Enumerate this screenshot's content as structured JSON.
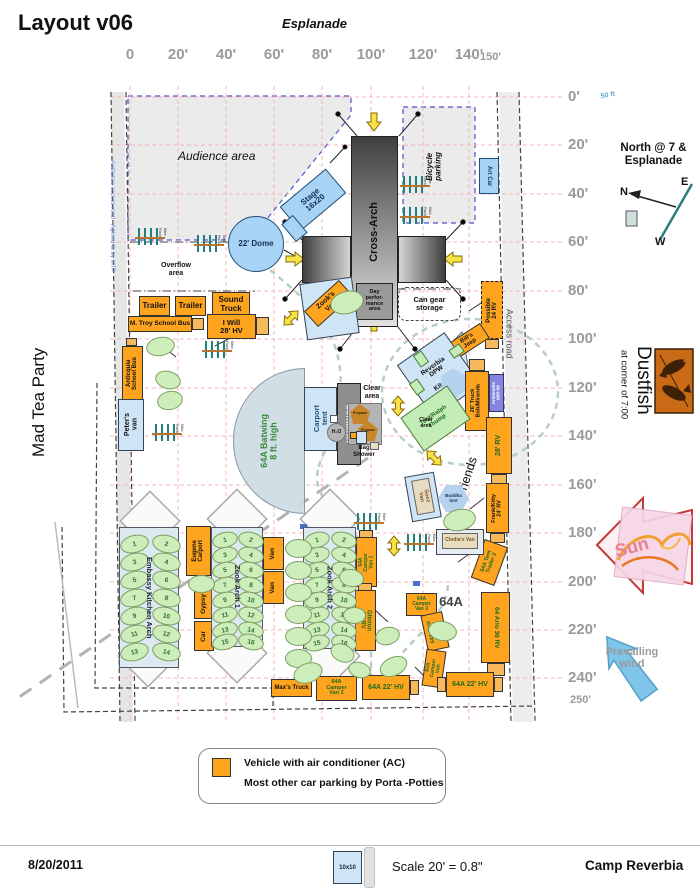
{
  "header": {
    "title": "Layout v06",
    "esplanade": "Esplanade"
  },
  "side": {
    "left": "Mad Tea Party",
    "dustfish": "Dustfish",
    "dustfish_sub": "at corner of 7:00",
    "camp_bottom": "Camp Reverbia"
  },
  "compass": {
    "title": "North @ 7 &\nEsplanade",
    "n": "N",
    "e": "E",
    "w": "W"
  },
  "rulers": {
    "top": [
      "0",
      "20'",
      "40'",
      "60'",
      "80'",
      "100'",
      "120'",
      "140'"
    ],
    "top_end": "150'",
    "right": [
      "0'",
      "20'",
      "40'",
      "60'",
      "80'",
      "100'",
      "120'",
      "140'",
      "160'",
      "180'",
      "200'",
      "220'",
      "240'"
    ],
    "right_end": "250'"
  },
  "legend": {
    "line1": "Vehicle with air conditioner (AC)",
    "line2": "Most other car parking by Porta -Potties"
  },
  "footer": {
    "date": "8/20/2011",
    "tent": "10x10",
    "scale": "Scale 20' = 0.8\"",
    "camp": "Camp Reverbia"
  },
  "colors": {
    "ac_vehicle": "#ffa41e",
    "structure_blue": "#a9d3f5",
    "parking_green": "#cdeebb",
    "grid_pink": "#f4b6b6"
  },
  "labels": [
    {
      "t": "Audience area",
      "x": 178,
      "y": 150,
      "fs": 12,
      "it": 1,
      "wt": 500,
      "nm": "audience-area-label"
    },
    {
      "t": "Overflow\narea",
      "x": 150,
      "y": 262,
      "w": 52,
      "fs": 7,
      "wt": 600,
      "nm": "overflow-area-label"
    },
    {
      "t": "Clear\narea",
      "x": 352,
      "y": 385,
      "w": 40,
      "fs": 7,
      "wt": 700,
      "nm": "clear-area-label"
    },
    {
      "t": "Clear\narea",
      "x": 410,
      "y": 417,
      "w": 32,
      "fs": 5.5,
      "wt": 700,
      "nm": "clear-area-label"
    },
    {
      "t": "Bag\nShower",
      "x": 342,
      "y": 445,
      "w": 44,
      "fs": 6,
      "wt": 700,
      "nm": "bag-shower-label"
    },
    {
      "t": "64A",
      "x": 436,
      "y": 595,
      "w": 30,
      "fs": 13,
      "wt": 600,
      "tc": "#444",
      "nm": "area-64a-label"
    },
    {
      "t": "50 ft",
      "x": 596,
      "y": 92,
      "w": 24,
      "fs": 7,
      "tc": "#5fa8d0",
      "r": -10,
      "wt": 600,
      "nm": "fifty-ft-label"
    },
    {
      "t": "Sun",
      "x": 602,
      "y": 538,
      "w": 60,
      "fs": 18,
      "tc": "#e8808f",
      "r": -15,
      "wt": 700,
      "nm": "sun-label"
    },
    {
      "t": "Prevailing\nwind",
      "x": 594,
      "y": 646,
      "w": 76,
      "fs": 11,
      "tc": "#9a9a9a",
      "wt": 600,
      "nm": "prevailing-wind-label"
    }
  ],
  "boxes": [
    {
      "t": "Audience access road - Agreed to by MTP",
      "x": 104,
      "y": 96,
      "w": 16,
      "h": 240,
      "c": "none",
      "v": "d",
      "fs": 6,
      "tc": "#7090e8",
      "wt": 400,
      "nm": "audience-access-road-label"
    },
    {
      "t": "Access road",
      "x": 500,
      "y": 286,
      "w": 18,
      "h": 95,
      "c": "none",
      "v": "d",
      "fs": 9,
      "tc": "#555",
      "wt": 400,
      "nm": "access-road-label"
    },
    {
      "t": "Bicycle\nparking",
      "x": 421,
      "y": 128,
      "w": 26,
      "h": 76,
      "c": "none",
      "v": "u",
      "fs": 8,
      "it": 1,
      "wt": 600,
      "nm": "bicycle-parking-label"
    },
    {
      "t": "Sooz & Friends",
      "x": 415,
      "y": 491,
      "w": 90,
      "h": 14,
      "c": "none",
      "r": -72,
      "fs": 12.5,
      "wt": 500,
      "nm": "sooz-friends-label"
    },
    {
      "t": "Cross-Arch",
      "x": 351,
      "y": 136,
      "w": 47,
      "h": 191,
      "c": "crossv",
      "v": "u",
      "fs": 11,
      "nm": "cross-arch"
    },
    {
      "t": "",
      "x": 302,
      "y": 236,
      "w": 49,
      "h": 47,
      "c": "crossh1",
      "nm": "cross-arch-left"
    },
    {
      "t": "",
      "x": 398,
      "y": 236,
      "w": 48,
      "h": 47,
      "c": "crossh2",
      "nm": "cross-arch-right"
    },
    {
      "t": "Day\nperfor-\nmance\narea",
      "x": 356,
      "y": 283,
      "w": 37,
      "h": 37,
      "c": "dkgray",
      "fs": 5.5,
      "nm": "day-performance-area"
    },
    {
      "t": "22' Dome",
      "x": 228,
      "y": 216,
      "w": 56,
      "h": 56,
      "c": "blue circle",
      "fs": 8,
      "tc": "#0d3355",
      "nm": "dome"
    },
    {
      "t": "Stage\n16x20",
      "x": 283,
      "y": 184,
      "w": 60,
      "h": 32,
      "c": "blue",
      "r": -40,
      "fs": 8,
      "tc": "#0d3355",
      "nm": "stage"
    },
    {
      "t": "",
      "x": 287,
      "y": 217,
      "w": 15,
      "h": 23,
      "c": "blue",
      "r": -40,
      "nm": "stage-stairs"
    },
    {
      "t": "Art Car",
      "x": 479,
      "y": 158,
      "w": 20,
      "h": 36,
      "c": "blue",
      "v": "d",
      "fs": 6,
      "tc": "#123a66",
      "nm": "art-car"
    },
    {
      "t": "Trailer",
      "x": 139,
      "y": 296,
      "w": 31,
      "h": 20,
      "c": "ac",
      "fs": 8,
      "nm": "trailer"
    },
    {
      "t": "Trailer",
      "x": 175,
      "y": 296,
      "w": 31,
      "h": 20,
      "c": "ac",
      "fs": 8,
      "nm": "trailer"
    },
    {
      "t": "Sound\nTruck",
      "x": 212,
      "y": 292,
      "w": 38,
      "h": 25,
      "c": "ac",
      "fs": 8,
      "nm": "sound-truck"
    },
    {
      "t": "M. Troy School Bus",
      "x": 128,
      "y": 316,
      "w": 64,
      "h": 16,
      "c": "ac",
      "fs": 6.5,
      "nm": "school-bus"
    },
    {
      "t": "",
      "x": 192,
      "y": 318,
      "w": 12,
      "h": 12,
      "c": "acl"
    },
    {
      "t": "I Will\n28' HV",
      "x": 207,
      "y": 314,
      "w": 49,
      "h": 25,
      "c": "ac",
      "fs": 7.5,
      "nm": "i-will-hv"
    },
    {
      "t": "",
      "x": 256,
      "y": 317,
      "w": 13,
      "h": 18,
      "c": "acl"
    },
    {
      "t": "",
      "x": 126,
      "y": 338,
      "w": 11,
      "h": 8,
      "c": "acl"
    },
    {
      "t": "Anticquia\nSchool Bus",
      "x": 122,
      "y": 346,
      "w": 21,
      "h": 55,
      "c": "ac",
      "v": "u",
      "fs": 6,
      "nm": "anticquia-school-bus"
    },
    {
      "t": "Peter's\nvan",
      "x": 118,
      "y": 399,
      "w": 26,
      "h": 52,
      "c": "ltblue",
      "v": "u",
      "fs": 7,
      "nm": "peters-van"
    },
    {
      "t": "",
      "x": 303,
      "y": 280,
      "w": 53,
      "h": 57,
      "c": "ltblue",
      "r": -8,
      "nm": "zook-van-pad"
    },
    {
      "t": "Zook's\nVan",
      "x": 305,
      "y": 293,
      "w": 47,
      "h": 21,
      "c": "ac",
      "r": -42,
      "fs": 7,
      "nm": "zooks-van"
    },
    {
      "t": "Can gear\nstorage",
      "x": 398,
      "y": 287,
      "w": 63,
      "h": 34,
      "c": "dash",
      "fs": 7.5,
      "nm": "can-gear-storage"
    },
    {
      "t": "Possible\n24 RV",
      "x": 481,
      "y": 281,
      "w": 22,
      "h": 58,
      "c": "ac bd",
      "v": "u",
      "fs": 6,
      "nm": "possible-rv"
    },
    {
      "t": "",
      "x": 485,
      "y": 339,
      "w": 14,
      "h": 10,
      "c": "acl"
    },
    {
      "t": "Bill's\nJeep",
      "x": 449,
      "y": 332,
      "w": 39,
      "h": 18,
      "c": "ac",
      "r": -33,
      "fs": 6,
      "nm": "bills-jeep"
    },
    {
      "t": "",
      "x": 419,
      "y": 347,
      "w": 19,
      "h": 12,
      "c": "green",
      "r": -33
    },
    {
      "t": "Reverbia\nDPW\n\nKitchen",
      "x": 410,
      "y": 343,
      "w": 58,
      "h": 64,
      "c": "ltblue",
      "r": -35,
      "fs": 6.5,
      "nm": "reverbia-dpw-kitchen"
    },
    {
      "t": "",
      "x": 440,
      "y": 370,
      "w": 28,
      "h": 26,
      "c": "hex ghex",
      "r": -35,
      "nm": "kitchen-hex"
    },
    {
      "t": "",
      "x": 416,
      "y": 352,
      "w": 10,
      "h": 14,
      "c": "green",
      "r": -35
    },
    {
      "t": "",
      "x": 412,
      "y": 380,
      "w": 10,
      "h": 14,
      "c": "green",
      "r": -35
    },
    {
      "t": "",
      "x": 450,
      "y": 346,
      "w": 13,
      "h": 10,
      "c": "green",
      "r": -35
    },
    {
      "t": "26' Truck\nBob/Miranda",
      "x": 465,
      "y": 371,
      "w": 24,
      "h": 60,
      "c": "ac",
      "v": "u",
      "fs": 5.5,
      "nm": "truck-26"
    },
    {
      "t": "",
      "x": 469,
      "y": 359,
      "w": 16,
      "h": 12,
      "c": "acl"
    },
    {
      "t": "Antoinette\nW/H 09",
      "x": 489,
      "y": 374,
      "w": 15,
      "h": 38,
      "c": "purple",
      "v": "u",
      "fs": 4.5,
      "tc": "#fff",
      "nm": "antoinette"
    },
    {
      "t": "28' RV",
      "x": 486,
      "y": 417,
      "w": 26,
      "h": 57,
      "c": "ac",
      "v": "u",
      "fs": 7,
      "tc": "#1d6b1d",
      "nm": "rv-28"
    },
    {
      "t": "",
      "x": 491,
      "y": 474,
      "w": 16,
      "h": 10,
      "c": "acl"
    },
    {
      "t": "Frank/Kitty\n24' RV",
      "x": 486,
      "y": 483,
      "w": 23,
      "h": 50,
      "c": "ac",
      "v": "u",
      "fs": 5.5,
      "nm": "frank-kitty-rv"
    },
    {
      "t": "",
      "x": 490,
      "y": 533,
      "w": 15,
      "h": 10,
      "c": "acl"
    },
    {
      "t": "Tent/Ralph\nThump",
      "x": 407,
      "y": 398,
      "w": 57,
      "h": 41,
      "c": "green",
      "r": -35,
      "fs": 6,
      "tc": "#1d6b1d",
      "nm": "tent-ralph"
    },
    {
      "t": "64A Batwing\n8 ft. high",
      "x": 233,
      "y": 368,
      "w": 72,
      "h": 146,
      "c": "batwing",
      "v": "u",
      "fs": 9,
      "tc": "#3a8a3a",
      "nm": "batwing"
    },
    {
      "t": "Carport\ntent",
      "x": 304,
      "y": 387,
      "w": 33,
      "h": 64,
      "c": "ltblue",
      "v": "u",
      "fs": 7.5,
      "tc": "#1c4f7c",
      "nm": "carport-tent"
    },
    {
      "t": "Container",
      "x": 337,
      "y": 383,
      "w": 24,
      "h": 82,
      "c": "gray",
      "v": "d",
      "fs": 8.5,
      "tc": "#fff",
      "nm": "container"
    },
    {
      "t": "",
      "x": 330,
      "y": 415,
      "w": 8,
      "h": 8,
      "c": "white"
    },
    {
      "t": "",
      "x": 330,
      "y": 427,
      "w": 8,
      "h": 8,
      "c": "ltblue"
    },
    {
      "t": "",
      "x": 348,
      "y": 403,
      "w": 34,
      "h": 42,
      "c": "midgray",
      "nm": "propane-pad"
    },
    {
      "t": "Propane",
      "x": 350,
      "y": 404,
      "w": 20,
      "h": 20,
      "c": "pent",
      "fs": 3.5,
      "tc": "#33220a",
      "nm": "propane"
    },
    {
      "t": "Propane",
      "x": 358,
      "y": 421,
      "w": 20,
      "h": 20,
      "c": "pent",
      "fs": 3.5,
      "tc": "#33220a",
      "nm": "propane"
    },
    {
      "t": "H₂O",
      "x": 327,
      "y": 423,
      "w": 19,
      "h": 19,
      "c": "midgray circle",
      "fs": 5,
      "nm": "h2o"
    },
    {
      "t": "",
      "x": 356,
      "y": 431,
      "w": 11,
      "h": 13,
      "c": "ltblue"
    },
    {
      "t": "",
      "x": 350,
      "y": 432,
      "w": 7,
      "h": 7,
      "c": "ac"
    },
    {
      "t": "",
      "x": 370,
      "y": 442,
      "w": 9,
      "h": 8,
      "c": "tan"
    },
    {
      "t": "Eugene\nCarport",
      "x": 186,
      "y": 526,
      "w": 25,
      "h": 50,
      "c": "ac",
      "v": "u",
      "fs": 6,
      "nm": "eugene-carport"
    },
    {
      "t": "Gypsy",
      "x": 194,
      "y": 589,
      "w": 20,
      "h": 30,
      "c": "ac",
      "v": "u",
      "fs": 6.5,
      "nm": "gypsy"
    },
    {
      "t": "Car",
      "x": 194,
      "y": 621,
      "w": 20,
      "h": 30,
      "c": "ac",
      "v": "u",
      "fs": 6.5,
      "nm": "car"
    },
    {
      "t": "Van",
      "x": 263,
      "y": 537,
      "w": 21,
      "h": 33,
      "c": "ac",
      "v": "u",
      "fs": 6.5,
      "nm": "van"
    },
    {
      "t": "Van",
      "x": 263,
      "y": 571,
      "w": 21,
      "h": 33,
      "c": "ac",
      "v": "u",
      "fs": 6.5,
      "nm": "van"
    },
    {
      "t": "Max's Truck",
      "x": 271,
      "y": 679,
      "w": 41,
      "h": 18,
      "c": "ac",
      "fs": 6,
      "nm": "maxs-truck"
    },
    {
      "t": "64A\nCamper\nVan 2",
      "x": 316,
      "y": 676,
      "w": 41,
      "h": 25,
      "c": "ac",
      "fs": 5.5,
      "tc": "#1d6b1d",
      "nm": "camper-van-2"
    },
    {
      "t": "64A\nCamper\nVan 1",
      "x": 356,
      "y": 537,
      "w": 21,
      "h": 50,
      "c": "ac",
      "v": "u",
      "fs": 5,
      "tc": "#1d6b1d",
      "nm": "camper-van-1"
    },
    {
      "t": "",
      "x": 359,
      "y": 530,
      "w": 14,
      "h": 8,
      "c": "acl"
    },
    {
      "t": "Glinton\n24 RV",
      "x": 355,
      "y": 590,
      "w": 21,
      "h": 61,
      "c": "ac",
      "v": "d",
      "fs": 6,
      "tc": "#1d6b1d",
      "nm": "glinton-rv"
    },
    {
      "t": "",
      "x": 358,
      "y": 583,
      "w": 14,
      "h": 8,
      "c": "acl"
    },
    {
      "t": "64A\nCamper\nVan 3",
      "x": 406,
      "y": 593,
      "w": 31,
      "h": 23,
      "c": "ac",
      "fs": 5,
      "tc": "#1d6b1d",
      "nm": "camper-van-3"
    },
    {
      "t": "64A Tent\nTrailer",
      "x": 424,
      "y": 613,
      "w": 22,
      "h": 37,
      "c": "ac",
      "v": "u",
      "r": -12,
      "fs": 5.5,
      "tc": "#1d6b1d",
      "nm": "tent-trailer"
    },
    {
      "t": "64 Arlo 36 RV",
      "x": 481,
      "y": 592,
      "w": 29,
      "h": 71,
      "c": "ac",
      "v": "d",
      "fs": 6.5,
      "tc": "#1d6b1d",
      "nm": "arlo-rv"
    },
    {
      "t": "",
      "x": 487,
      "y": 663,
      "w": 18,
      "h": 13,
      "c": "acl"
    },
    {
      "t": "64A Tent\nTrailer 2",
      "x": 477,
      "y": 542,
      "w": 25,
      "h": 41,
      "c": "ac",
      "v": "u",
      "r": 20,
      "fs": 5.5,
      "tc": "#1d6b1d",
      "nm": "tent-trailer-2"
    },
    {
      "t": "64A\nCamper\nVan",
      "x": 424,
      "y": 650,
      "w": 20,
      "h": 37,
      "c": "ac",
      "v": "u",
      "r": 8,
      "fs": 5,
      "tc": "#1d6b1d",
      "nm": "camper-van"
    },
    {
      "t": "64A 22' HV",
      "x": 362,
      "y": 675,
      "w": 48,
      "h": 25,
      "c": "ac",
      "fs": 7,
      "tc": "#1d6b1d",
      "nm": "hv-left"
    },
    {
      "t": "",
      "x": 410,
      "y": 680,
      "w": 9,
      "h": 15,
      "c": "acl"
    },
    {
      "t": "64A 22' HV",
      "x": 446,
      "y": 672,
      "w": 48,
      "h": 25,
      "c": "ac",
      "fs": 7,
      "tc": "#1d6b1d",
      "nm": "hv-right"
    },
    {
      "t": "",
      "x": 437,
      "y": 677,
      "w": 9,
      "h": 15,
      "c": "acl"
    },
    {
      "t": "",
      "x": 494,
      "y": 677,
      "w": 9,
      "h": 15,
      "c": "acl"
    },
    {
      "t": "",
      "x": 436,
      "y": 529,
      "w": 48,
      "h": 26,
      "c": "ltgray",
      "nm": "clodias-van-pad"
    },
    {
      "t": "Clodia's Van",
      "x": 442,
      "y": 533,
      "w": 36,
      "h": 16,
      "c": "tan",
      "fs": 5,
      "tc": "#7a5520",
      "nm": "clodias-van"
    },
    {
      "t": "",
      "x": 408,
      "y": 474,
      "w": 30,
      "h": 46,
      "c": "ltblue",
      "r": -10,
      "nm": "sooz-van-pad"
    },
    {
      "t": "Sooz\nVan",
      "x": 414,
      "y": 479,
      "w": 18,
      "h": 35,
      "c": "tan",
      "v": "d",
      "r": -10,
      "fs": 5.5,
      "tc": "#7a5520",
      "nm": "sooz-van"
    },
    {
      "t": "Buddha\ntent",
      "x": 438,
      "y": 485,
      "w": 31,
      "h": 27,
      "c": "hex",
      "fs": 4.5,
      "tc": "#123a66",
      "nm": "buddha-tent"
    }
  ],
  "arches": [
    {
      "label": "Embassy Kitchen Arch",
      "x": 119,
      "y": 527,
      "w": 60,
      "h": 141,
      "cols": [
        133,
        165
      ],
      "rows": [
        543,
        561,
        579,
        597,
        615,
        633,
        651
      ],
      "ew": 27,
      "eh": 16,
      "nm": "embassy-kitchen-arch"
    },
    {
      "label": "Zook Arch 1",
      "x": 211,
      "y": 527,
      "w": 52,
      "h": 120,
      "cols": [
        224,
        250
      ],
      "rows": [
        539,
        554,
        569,
        584,
        599,
        614,
        629,
        641
      ],
      "ew": 24,
      "eh": 14,
      "nm": "zook-arch-1"
    },
    {
      "label": "Zook Arch 2",
      "x": 303,
      "y": 527,
      "w": 53,
      "h": 122,
      "cols": [
        316,
        343
      ],
      "rows": [
        539,
        554,
        569,
        584,
        599,
        614,
        629,
        642
      ],
      "ew": 24,
      "eh": 14,
      "nm": "zook-arch-2"
    }
  ],
  "ellipses": [
    [
      146,
      337,
      27,
      17,
      -10
    ],
    [
      155,
      371,
      24,
      16,
      15
    ],
    [
      157,
      391,
      24,
      17,
      -12
    ],
    [
      330,
      291,
      32,
      21,
      -15
    ],
    [
      188,
      575,
      25,
      16,
      0
    ],
    [
      339,
      569,
      23,
      16,
      10
    ],
    [
      343,
      607,
      21,
      15,
      0
    ],
    [
      330,
      644,
      23,
      16,
      25
    ],
    [
      375,
      627,
      23,
      16,
      -15
    ],
    [
      428,
      621,
      27,
      18,
      10
    ],
    [
      379,
      657,
      27,
      17,
      -25
    ],
    [
      348,
      662,
      21,
      14,
      15
    ],
    [
      443,
      509,
      31,
      20,
      -12
    ],
    [
      285,
      539,
      25,
      17,
      0
    ],
    [
      285,
      561,
      25,
      17,
      0
    ],
    [
      285,
      583,
      25,
      17,
      0
    ],
    [
      285,
      605,
      25,
      17,
      0
    ],
    [
      285,
      627,
      25,
      17,
      0
    ],
    [
      285,
      649,
      25,
      17,
      0
    ],
    [
      293,
      663,
      28,
      18,
      -20
    ]
  ],
  "bike_racks": {
    "label": "Bike Rack",
    "positions": [
      [
        138,
        228
      ],
      [
        197,
        235
      ],
      [
        403,
        176
      ],
      [
        403,
        207
      ],
      [
        205,
        341
      ],
      [
        155,
        424
      ],
      [
        357,
        513
      ],
      [
        407,
        534
      ]
    ]
  }
}
